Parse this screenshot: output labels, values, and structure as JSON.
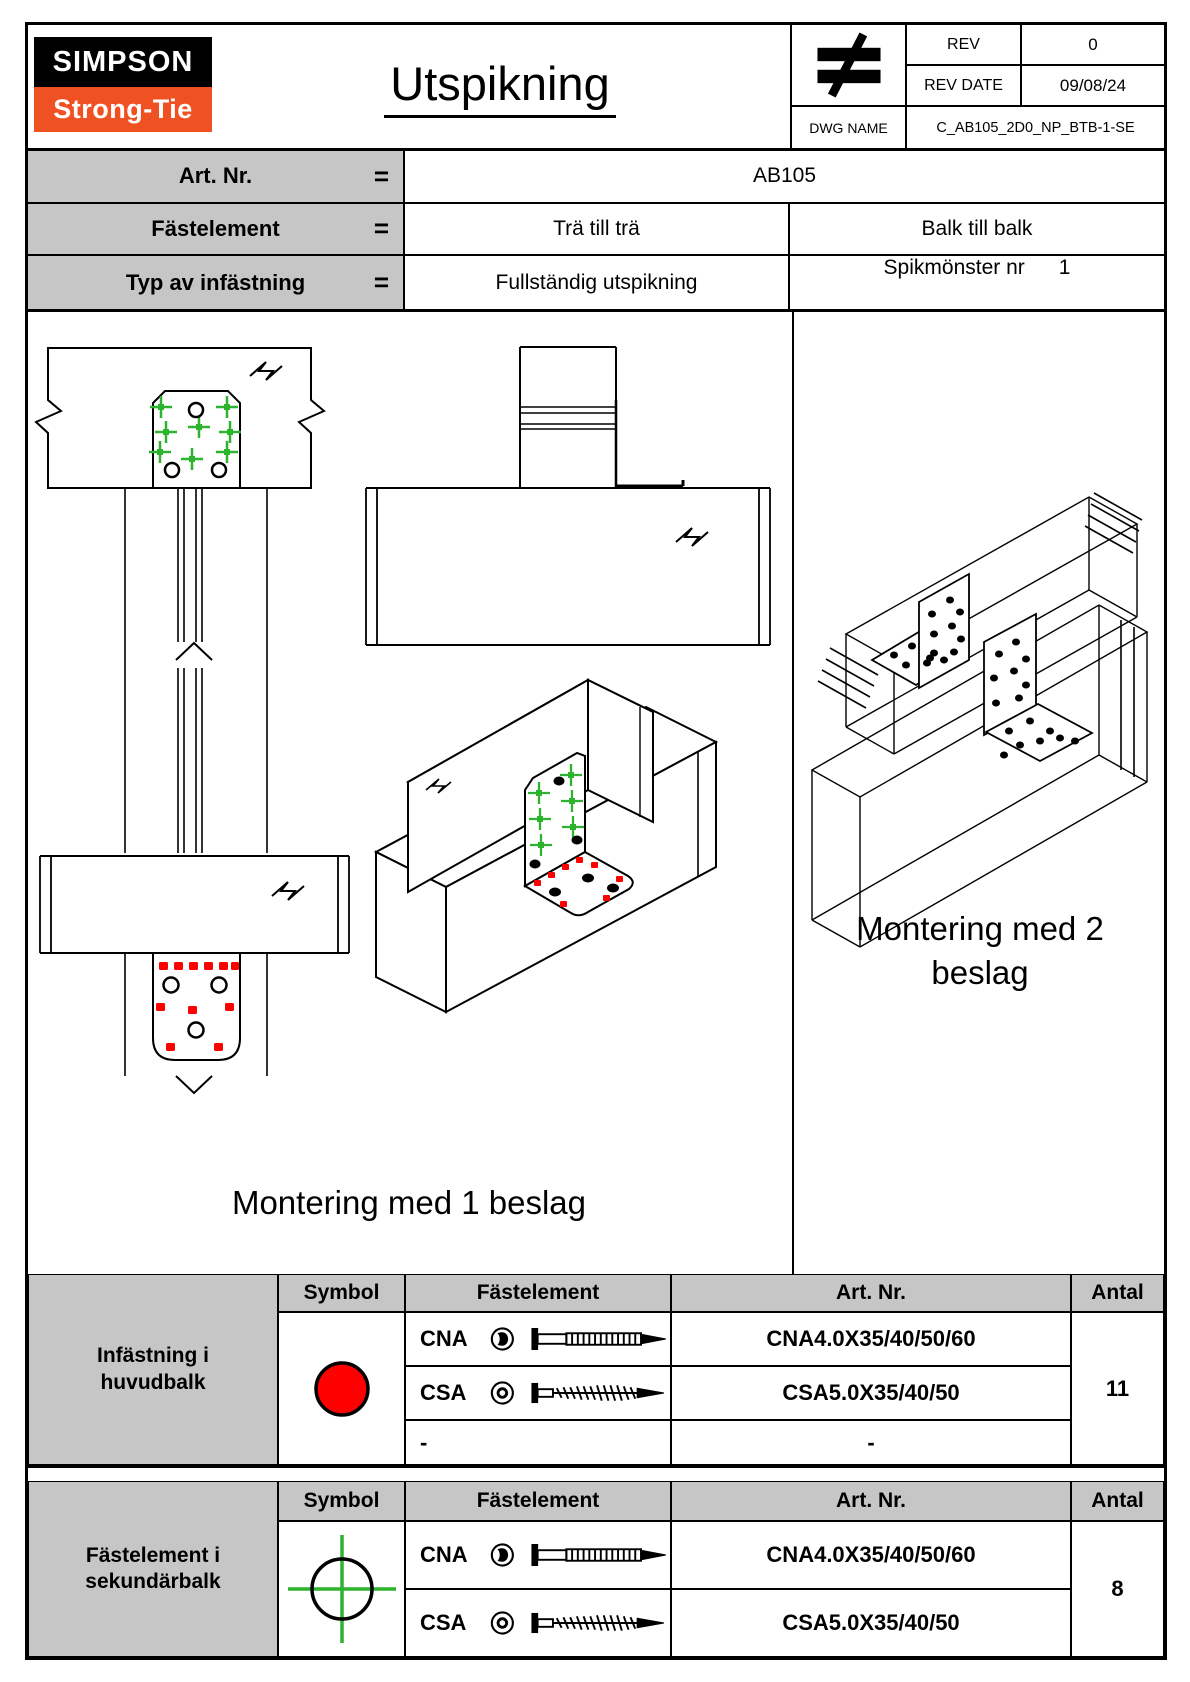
{
  "header": {
    "logo_top": "SIMPSON",
    "logo_bottom": "Strong-Tie",
    "title": "Utspikning",
    "rev_label": "REV",
    "rev_value": "0",
    "rev_date_label": "REV DATE",
    "rev_date_value": "09/08/24",
    "dwg_name_label": "DWG NAME",
    "dwg_name_value": "C_AB105_2D0_NP_BTB-1-SE"
  },
  "info": {
    "eq": "=",
    "art_label": "Art. Nr.",
    "art_value": "AB105",
    "fastelement_label": "Fästelement",
    "fastelement_value1": "Trä till trä",
    "fastelement_value2": "Balk till balk",
    "typ_label": "Typ av infästning",
    "typ_value1": "Fullständig utspikning",
    "typ_value2_label": "Spikmönster nr",
    "typ_value2_num": "1"
  },
  "drawings": {
    "caption_left": "Montering med 1 beslag",
    "caption_right_line1": "Montering med 2",
    "caption_right_line2": "beslag"
  },
  "table_headers": {
    "symbol": "Symbol",
    "fastelement": "Fästelement",
    "artnr": "Art. Nr.",
    "antal": "Antal"
  },
  "legend": {
    "huvudbalk": {
      "row_label": "Infästning i huvudbalk",
      "rows": [
        {
          "name": "CNA",
          "art": "CNA4.0X35/40/50/60"
        },
        {
          "name": "CSA",
          "art": "CSA5.0X35/40/50"
        },
        {
          "name": "-",
          "art": "-"
        }
      ],
      "antal": "11"
    },
    "sekundarbalk": {
      "row_label": "Fästelement i sekundärbalk",
      "rows": [
        {
          "name": "CNA",
          "art": "CNA4.0X35/40/50/60"
        },
        {
          "name": "CSA",
          "art": "CSA5.0X35/40/50"
        }
      ],
      "antal": "8"
    }
  },
  "colors": {
    "symbol_red": "#ff0000",
    "symbol_green": "#2db32d",
    "table_gray": "#c6c6c6",
    "logo_orange": "#f05123",
    "line_black": "#000000"
  }
}
